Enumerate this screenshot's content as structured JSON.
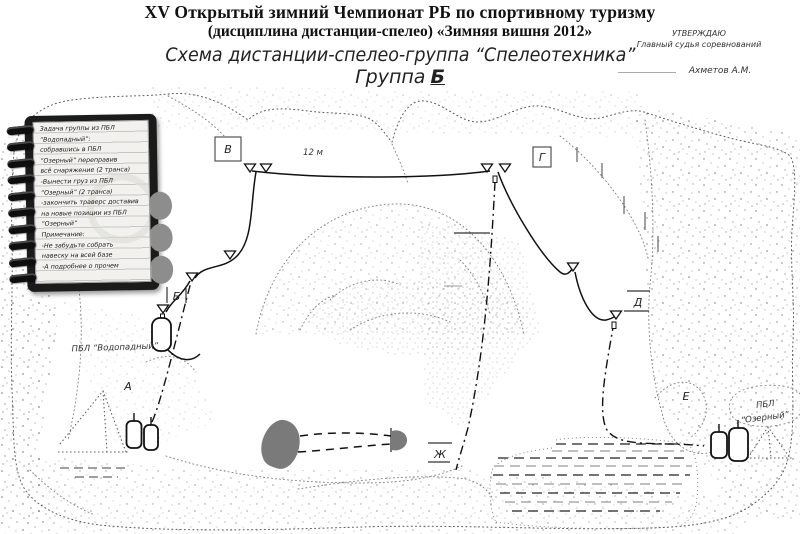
{
  "header": {
    "title_line1": "XV Открытый зимний Чемпионат РБ по спортивному туризму",
    "title_line2": "(дисциплина дистанции-спелео) «Зимняя вишня 2012»",
    "subtitle": "Схема дистанции-спелео-группа “Спелеотехника”",
    "group_prefix": "Группа",
    "group_letter": "Б"
  },
  "approval": {
    "line1": "УТВЕРЖДАЮ",
    "line2": "Главный судья соревнований",
    "signature_name": "Ахметов А.М."
  },
  "notebook": {
    "lines": [
      "Задача группы из ПБЛ",
      "“Водопадный”:",
      "",
      "собравшись в ПБЛ",
      "“Озерный” переправив",
      "всё снаряжение (2 транса)",
      "-Вынести груз из ПБЛ",
      "“Озерный” (2 транса)",
      "-закончить траверс доставив",
      "на новые позиции из ПБЛ",
      "“Озерный”",
      "Примечание:",
      "-Не забудьте собрать",
      "навеску на всей базе",
      "-А подробнее о прочем"
    ]
  },
  "map": {
    "checkpoints": {
      "a": "А",
      "b": "Б",
      "v": "В",
      "g": "Г",
      "d": "Д",
      "e": "Е",
      "zh": "Ж"
    },
    "traverse_length": "12 м",
    "camp_left": "ПБЛ “Водопадный”",
    "camp_right_line1": "ПБЛ",
    "camp_right_line2": "“Озерный”"
  },
  "colors": {
    "ink": "#111111",
    "lake_fill": "#7a7a7a",
    "notebook_cover": "#1b1b1b",
    "notebook_page": "#f2f1ee"
  }
}
